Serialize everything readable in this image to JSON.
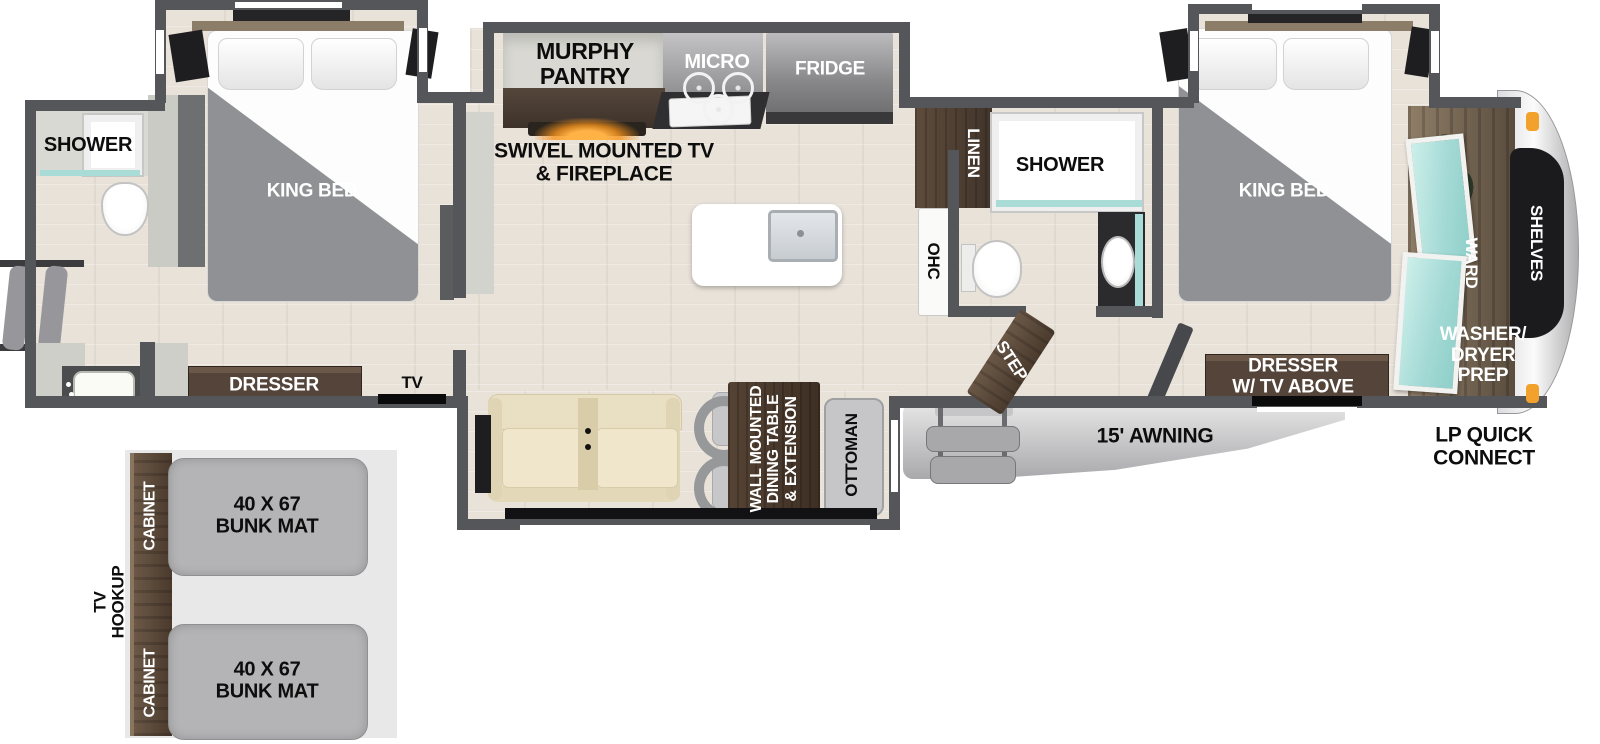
{
  "colors": {
    "wall": "#55565A",
    "floor_wood": "#E8E2D9",
    "cabinet_wood": "#54443A",
    "teal_glass": "#A9DCD6",
    "fireplace_glow": "#F7941D",
    "awning_gray": "#C9C9CB",
    "bunk_mat_gray": "#B4B4B6",
    "marker_light_orange": "#F2A22C"
  },
  "rear_bathroom": {
    "shower": "SHOWER"
  },
  "rear_bedroom": {
    "bed": "KING BED",
    "dresser": "DRESSER",
    "tv": "TV"
  },
  "kitchen": {
    "pantry": "MURPHY\nPANTRY",
    "tv_fireplace": "SWIVEL MOUNTED TV\n& FIREPLACE",
    "micro": "MICRO",
    "fridge": "FRIDGE"
  },
  "living_room": {
    "dining_table": "WALL MOUNTED\nDINING TABLE\n& EXTENSION",
    "ottoman": "OTTOMAN"
  },
  "mid_bathroom": {
    "linen": "LINEN",
    "shower": "SHOWER",
    "ohc": "OHC",
    "step": "STEP"
  },
  "front_bedroom": {
    "bed": "KING BED",
    "dresser_tv": "DRESSER\nW/ TV ABOVE"
  },
  "front_closet": {
    "ward": "WARD",
    "shelves": "SHELVES",
    "washer_dryer_prep": "WASHER/\nDRYER\nPREP"
  },
  "exterior": {
    "awning": "15' AWNING",
    "lp_quick_connect": "LP QUICK\nCONNECT"
  },
  "bunk_room": {
    "tv_hookup": "TV\nHOOKUP",
    "cabinet_top": "CABINET",
    "cabinet_bottom": "CABINET",
    "bunk_mat_top": "40 X 67\nBUNK MAT",
    "bunk_mat_bottom": "40 X 67\nBUNK MAT"
  }
}
